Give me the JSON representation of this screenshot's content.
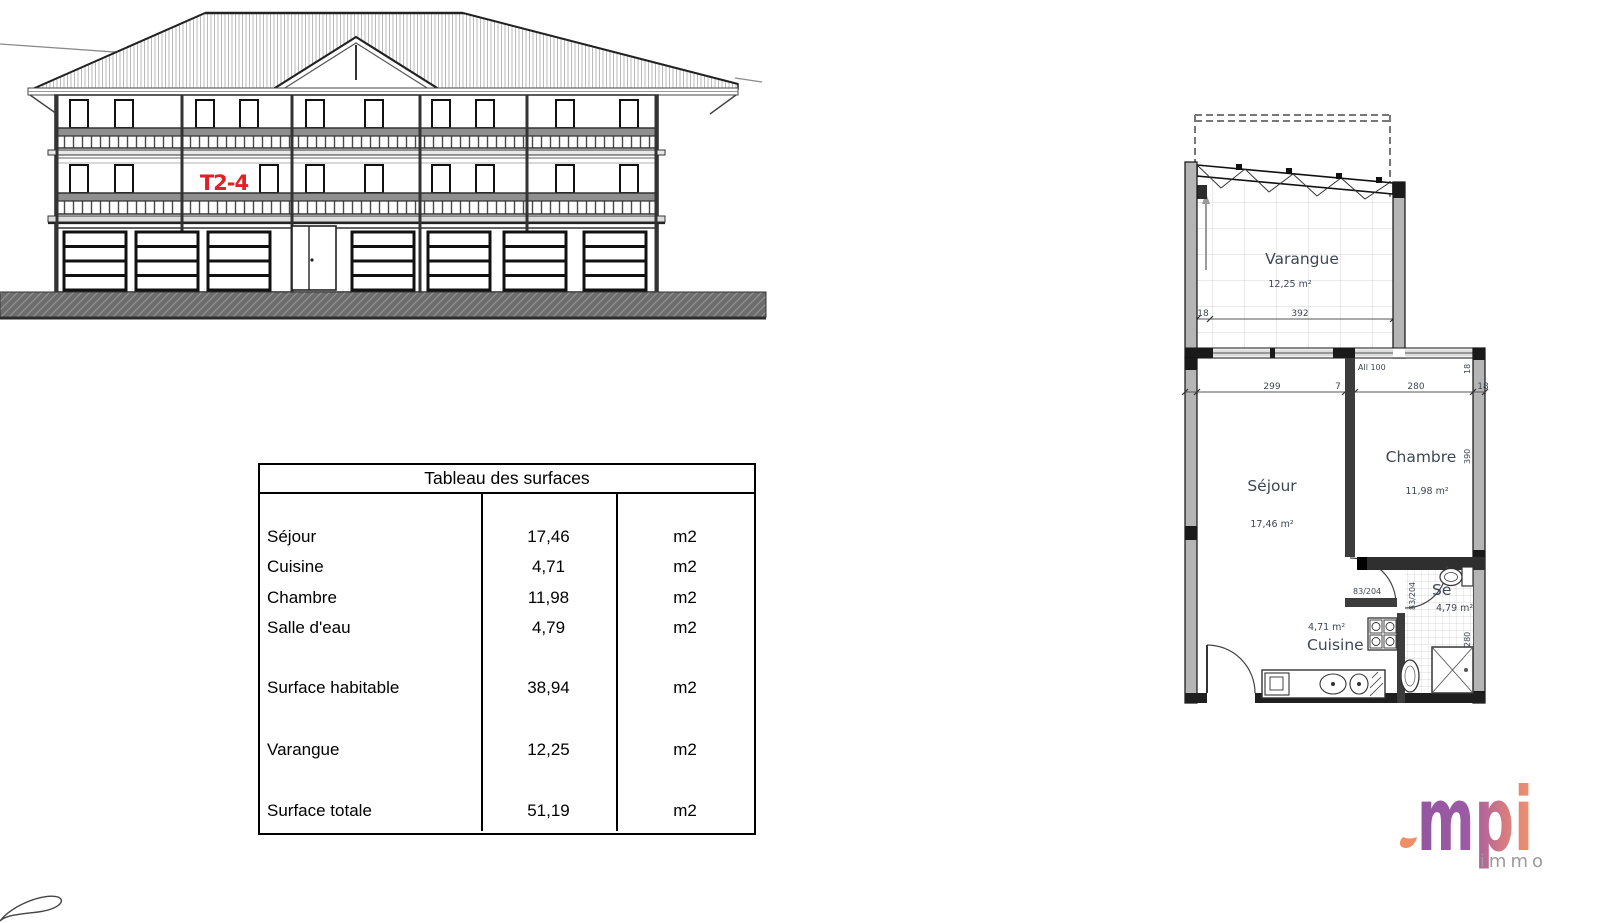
{
  "elevation": {
    "unit_label": "T2-4",
    "label_color": "#e31e24"
  },
  "surface_table": {
    "title": "Tableau des surfaces",
    "rows": [
      {
        "label": "Séjour",
        "value": "17,46",
        "unit": "m2"
      },
      {
        "label": "Cuisine",
        "value": "4,71",
        "unit": "m2"
      },
      {
        "label": "Chambre",
        "value": "11,98",
        "unit": "m2"
      },
      {
        "label": "Salle d'eau",
        "value": "4,79",
        "unit": "m2"
      },
      {
        "label": "Surface habitable",
        "value": "38,94",
        "unit": "m2"
      },
      {
        "label": "Varangue",
        "value": "12,25",
        "unit": "m2"
      },
      {
        "label": "Surface totale",
        "value": "51,19",
        "unit": "m2"
      }
    ]
  },
  "floor_plan": {
    "rooms": {
      "varangue": {
        "name": "Varangue",
        "area": "12,25 m²"
      },
      "sejour": {
        "name": "Séjour",
        "area": "17,46 m²"
      },
      "chambre": {
        "name": "Chambre",
        "area": "11,98 m²"
      },
      "cuisine": {
        "name": "Cuisine",
        "area": "4,71 m²"
      },
      "salle_eau": {
        "name": "Se",
        "area": "4,79 m²"
      }
    },
    "dimensions": {
      "varangue_wall": "18",
      "varangue_width": "392",
      "sejour_width": "299",
      "partition": "7",
      "chambre_width": "280",
      "right_wall": "18",
      "top_right_vert": "18",
      "chambre_depth": "390",
      "salle_eau_depth": "280"
    },
    "annotations": {
      "allege": "All 100",
      "door_sejour": "83/204",
      "door_salle_eau": "83/204"
    }
  },
  "logo": {
    "text": "mpi",
    "subtext": "immo",
    "purple": "#9a57a5",
    "orange": "#ef8f66",
    "gray": "#9b9b9b"
  }
}
